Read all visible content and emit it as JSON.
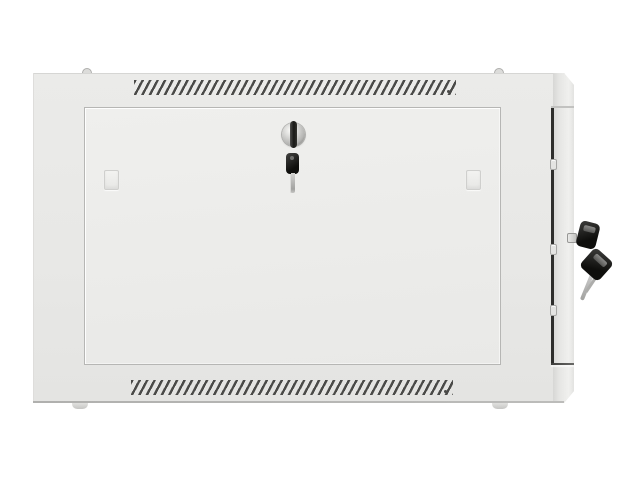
{
  "scene": {
    "type": "product-photo",
    "subject": "Light gray wall-mount network rack cabinet, front view, with vented top and bottom panels, recessed locked front door with key, and two keys hanging from the right side panel lock",
    "background_color": "#ffffff"
  },
  "cabinet": {
    "colors": {
      "background": "#ffffff",
      "frame": "#ebebe9",
      "frame_dark": "#e4e4e2",
      "door": "#efefed",
      "door_dark": "#e9e9e7",
      "vent_slat": "#4a4a48",
      "gap_line": "#2e2e2c",
      "lock_metal": "#d6d6d4",
      "key_black": "#0e0e0c",
      "key_metal": "#a2a2a0",
      "foot": "#c6c6c4"
    },
    "counts": {
      "vent_rows": 2,
      "door_clips": 2,
      "hinge_nubs": 3,
      "front_hanging_keys": 1,
      "side_hanging_keys": 2,
      "feet": 2,
      "top_screws": 2
    }
  }
}
